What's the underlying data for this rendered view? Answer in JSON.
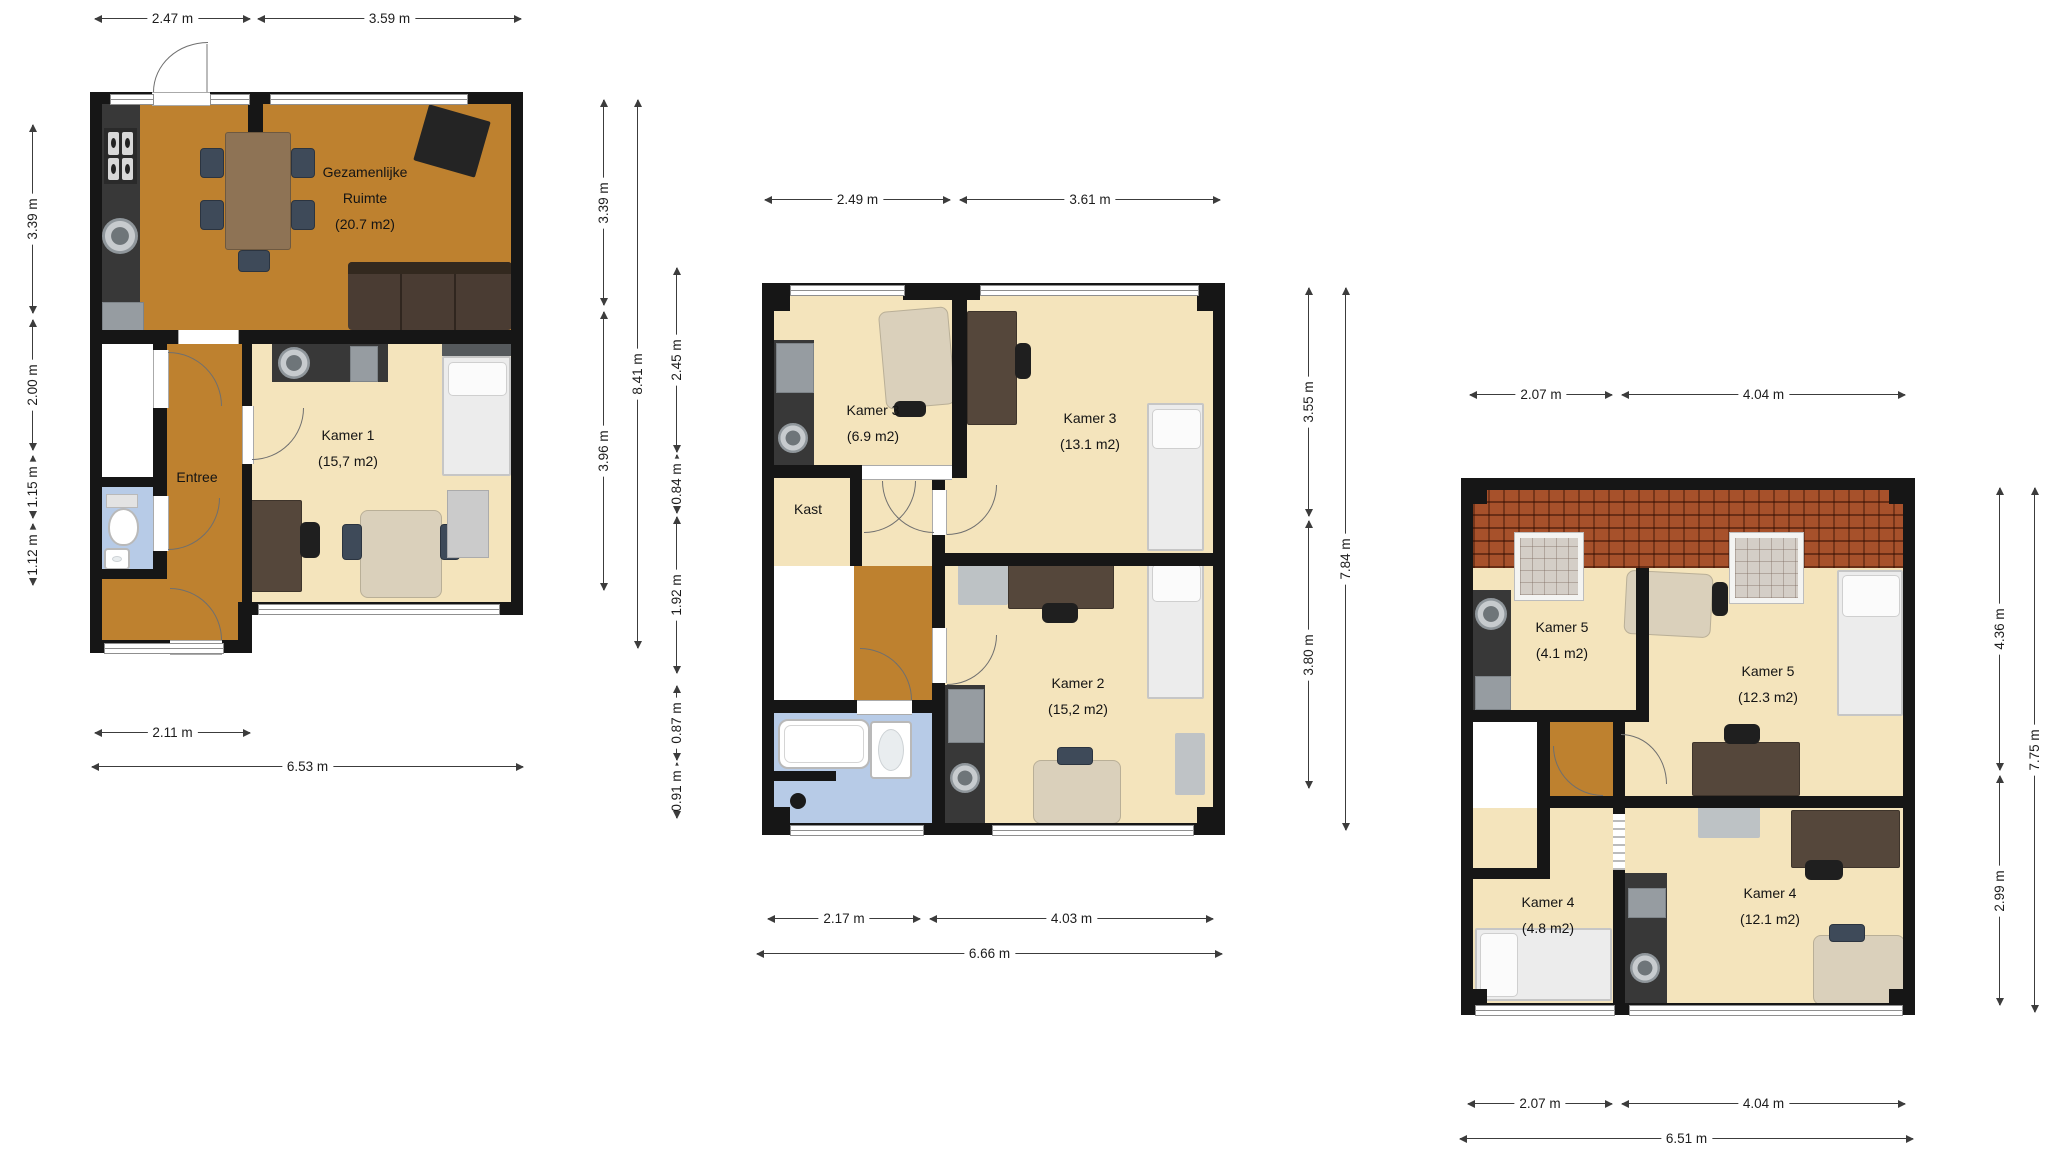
{
  "palette": {
    "wall": "#161616",
    "floor_common": "#BE812F",
    "floor_room": "#F4E4BC",
    "floor_bath": "#B7CBE7",
    "counter": "#383838",
    "roof": "#A7512B",
    "dim_line": "#3C3C3C"
  },
  "floors": {
    "ground": {
      "dims": {
        "top": [
          "2.47 m",
          "3.59 m"
        ],
        "left": [
          "3.39 m",
          "2.00 m",
          "1.15 m",
          "1.12 m"
        ],
        "right": [
          "3.39 m",
          "3.96 m"
        ],
        "right_total": "8.41 m",
        "bottom": [
          "2.11 m"
        ],
        "bottom_total": "6.53 m"
      },
      "rooms": {
        "common": {
          "line1": "Gezamenlijke",
          "line2": "Ruimte",
          "area": "(20.7 m2)"
        },
        "kamer1": {
          "name": "Kamer 1",
          "area": "(15,7 m2)"
        },
        "entree": {
          "name": "Entree"
        }
      }
    },
    "first": {
      "dims": {
        "top": [
          "2.49 m",
          "3.61 m"
        ],
        "left": [
          "2.45 m",
          "0.84 m",
          "1.92 m",
          "0.87 m",
          "0.91 m"
        ],
        "right": [
          "3.55 m",
          "3.80 m"
        ],
        "right_total": "7.84 m",
        "bottom": [
          "2.17 m",
          "4.03 m"
        ],
        "bottom_total": "6.66 m"
      },
      "rooms": {
        "kamer3a": {
          "name": "Kamer 3",
          "area": "(6.9 m2)"
        },
        "kamer3b": {
          "name": "Kamer 3",
          "area": "(13.1 m2)"
        },
        "kast": {
          "name": "Kast"
        },
        "kamer2": {
          "name": "Kamer 2",
          "area": "(15,2 m2)"
        }
      }
    },
    "second": {
      "dims": {
        "top": [
          "2.07 m",
          "4.04 m"
        ],
        "right": [
          "4.36 m",
          "2.99 m"
        ],
        "right_total": "7.75 m",
        "bottom": [
          "2.07 m",
          "4.04 m"
        ],
        "bottom_total": "6.51 m"
      },
      "rooms": {
        "kamer5a": {
          "name": "Kamer 5",
          "area": "(4.1 m2)"
        },
        "kamer5b": {
          "name": "Kamer 5",
          "area": "(12.3 m2)"
        },
        "kamer4a": {
          "name": "Kamer 4",
          "area": "(4.8 m2)"
        },
        "kamer4b": {
          "name": "Kamer 4",
          "area": "(12.1 m2)"
        }
      }
    }
  }
}
